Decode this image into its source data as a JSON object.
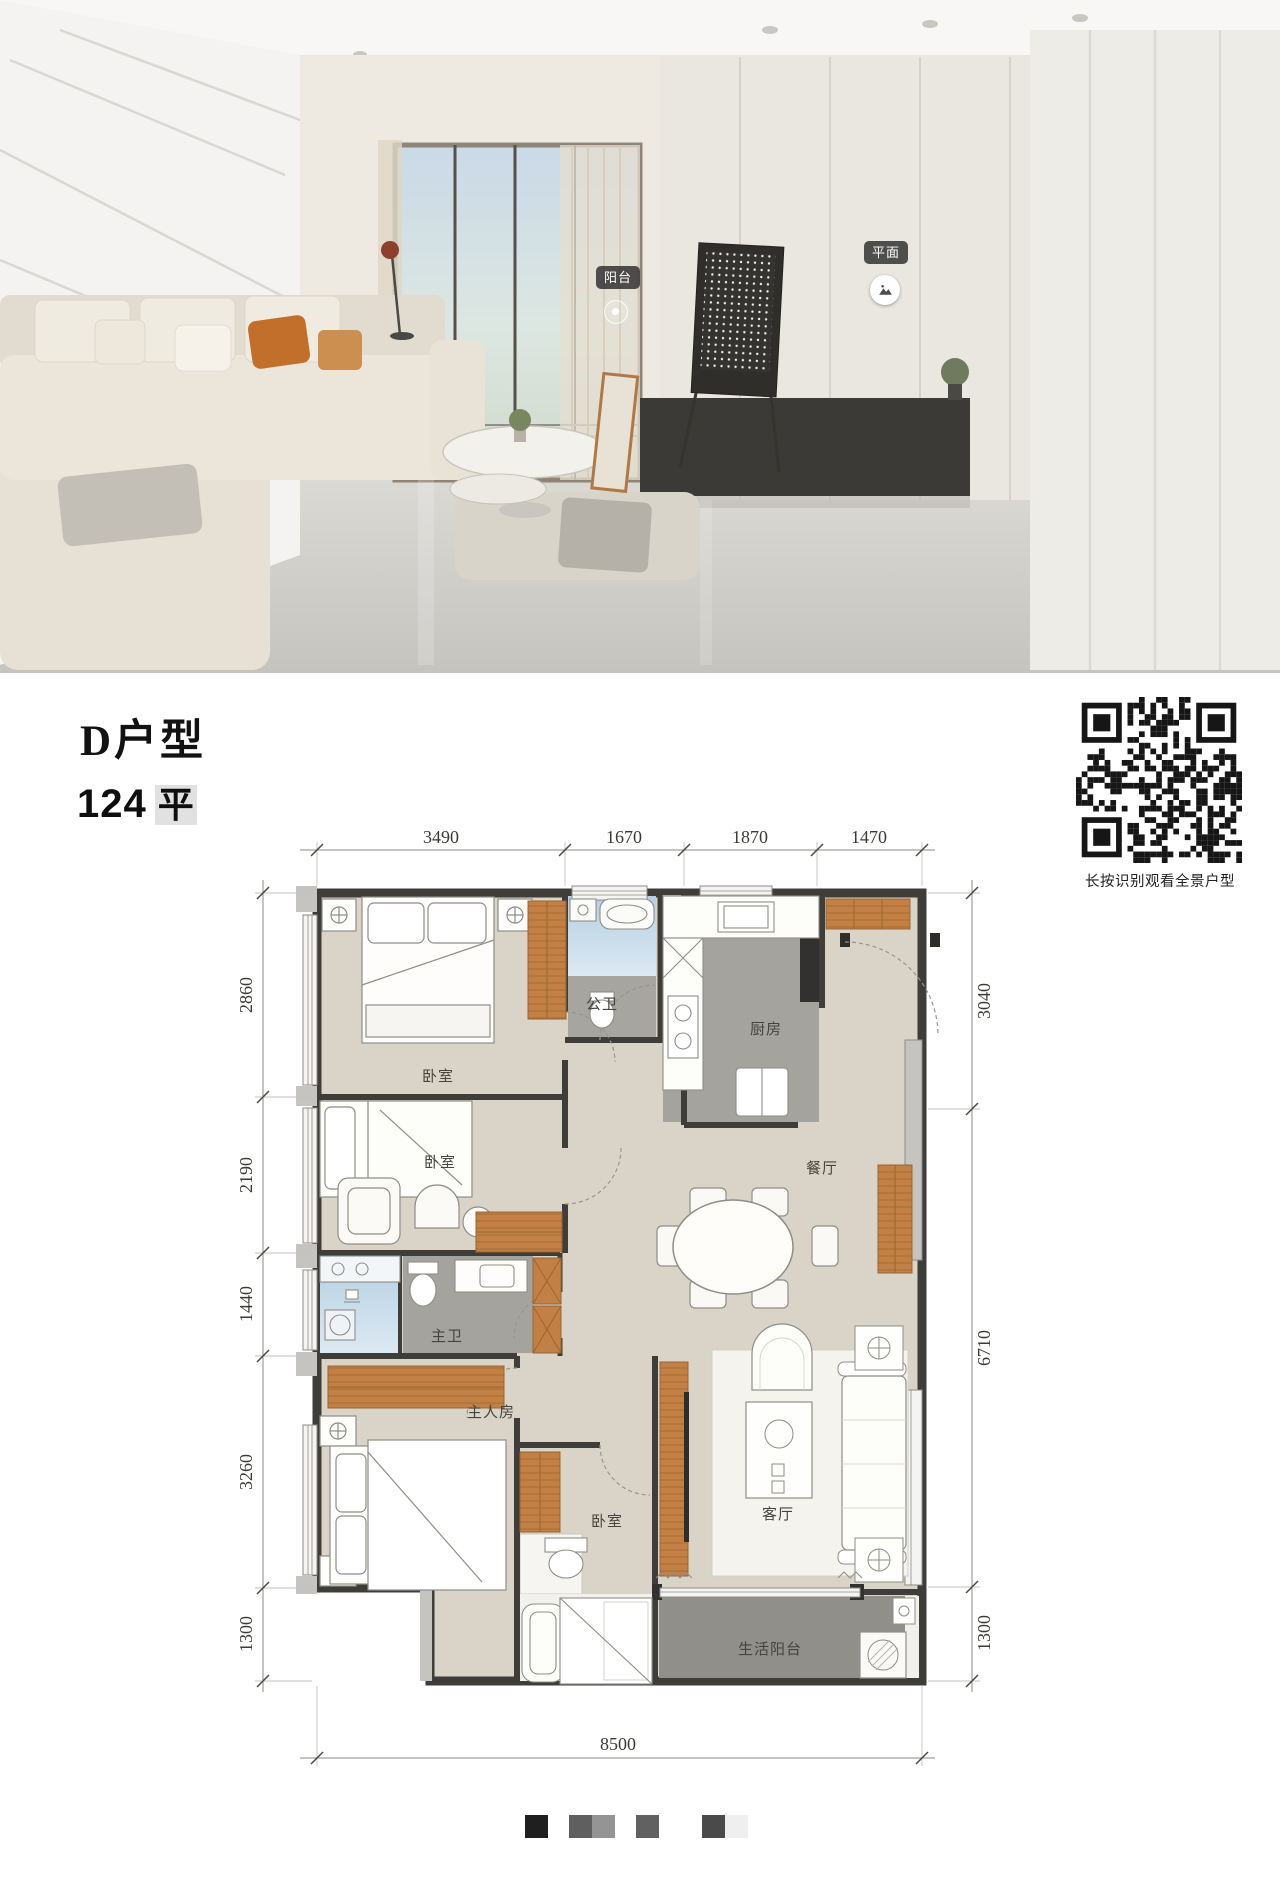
{
  "photo": {
    "balcony_tag": "阳台",
    "plan_tag": "平面"
  },
  "header": {
    "title": "D户型",
    "area_value": "124",
    "area_unit": "平"
  },
  "qr": {
    "caption": "长按识别观看全景户型"
  },
  "floorplan": {
    "rooms": [
      {
        "label": "卧室"
      },
      {
        "label": "公卫"
      },
      {
        "label": "厨房"
      },
      {
        "label": "餐厅"
      },
      {
        "label": "卧室"
      },
      {
        "label": "主卫"
      },
      {
        "label": "主人房"
      },
      {
        "label": "卧室"
      },
      {
        "label": "客厅"
      },
      {
        "label": "生活阳台"
      }
    ],
    "dims_top": [
      "3490",
      "1670",
      "1870",
      "1470"
    ],
    "dims_left": [
      "2860",
      "2190",
      "1440",
      "3260",
      "1300"
    ],
    "dims_right": [
      "3040",
      "6710",
      "1300"
    ],
    "dim_bottom": "8500",
    "colors": {
      "wall": "#3e3d3a",
      "floor_beige": "#d9d4c7",
      "wet_gray": "#a4a39e",
      "bath_blue": "#b4cfe2",
      "balcony_gray": "#918f8a",
      "accent_orange": "#c28045",
      "window_gray": "#c5c4c0"
    }
  },
  "footer": {
    "swatches": [
      {
        "colors": [
          "#1f1f1f"
        ]
      },
      {
        "colors": [
          "#5f5f5f",
          "#949494"
        ]
      },
      {
        "colors": [
          "#616161"
        ]
      },
      {
        "colors": [
          "#4a4a4a",
          "#efefef"
        ]
      }
    ]
  }
}
